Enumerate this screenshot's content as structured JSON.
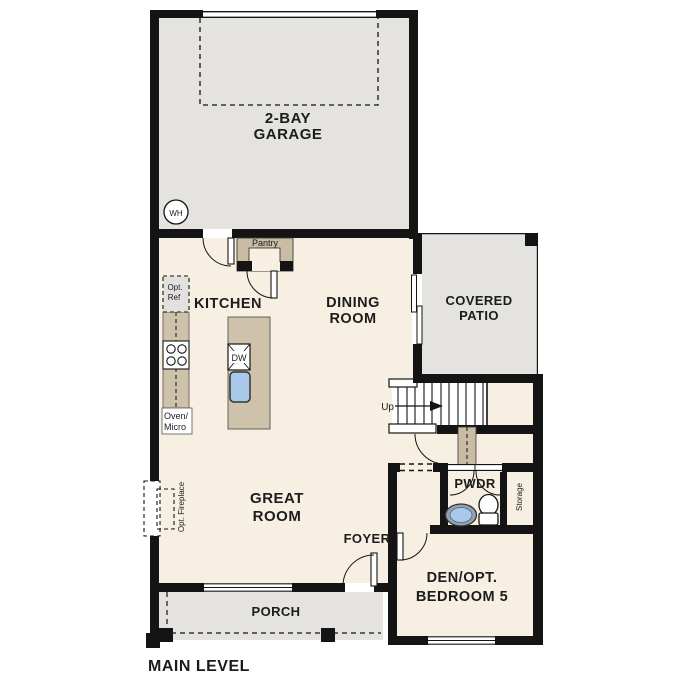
{
  "plan_title": "MAIN LEVEL",
  "colors": {
    "wall": "#141414",
    "floor_cream": "#f7efe2",
    "exterior_gray": "#e4e3e0",
    "counter_tan": "#cec2ab",
    "pantry_tan": "#c8bca5",
    "sink_blue": "#a9c9e9",
    "sink_ring_gray": "#97a1ab"
  },
  "rooms": {
    "garage": {
      "line1": "2-BAY",
      "line2": "GARAGE"
    },
    "kitchen": {
      "label": "KITCHEN"
    },
    "dining": {
      "line1": "DINING",
      "line2": "ROOM"
    },
    "covered_patio": {
      "line1": "COVERED",
      "line2": "PATIO"
    },
    "great_room": {
      "line1": "GREAT",
      "line2": "ROOM"
    },
    "foyer": {
      "label": "FOYER"
    },
    "porch": {
      "label": "PORCH"
    },
    "powder": {
      "label": "PWDR"
    },
    "storage": {
      "label": "Storage"
    },
    "den": {
      "line1": "DEN/OPT.",
      "line2": "BEDROOM 5"
    }
  },
  "fixtures": {
    "water_heater": "WH",
    "dishwasher": "DW",
    "pantry": "Pantry",
    "opt_ref_line1": "Opt.",
    "opt_ref_line2": "Ref",
    "oven_line1": "Oven/",
    "oven_line2": "Micro",
    "stairs_up": "Up",
    "opt_fireplace": "Opt. Fireplace"
  }
}
